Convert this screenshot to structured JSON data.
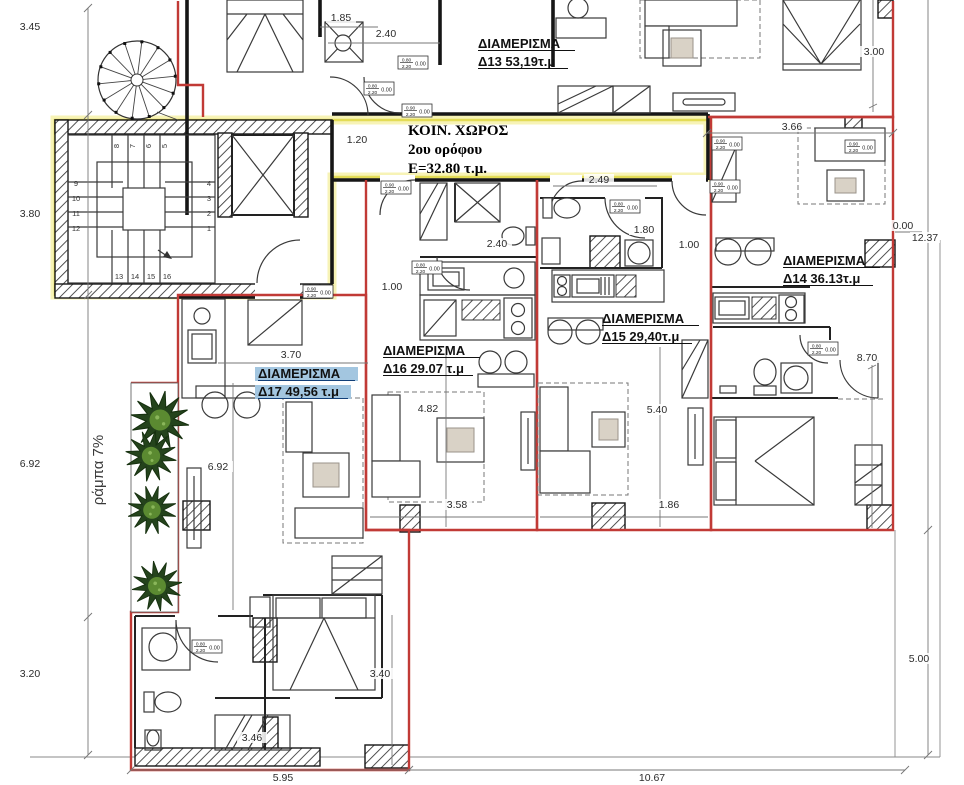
{
  "colors": {
    "apartment_boundary_red": "#c13a36",
    "common_boundary_yellow": "#e3dc55",
    "wall_black": "#161616",
    "highlight_fill": "#a3c6e0",
    "highlight_text": "#123f78",
    "tree_dark": "#24431c",
    "tree_light": "#5b8a31",
    "dimension_text": "#2b2b2b"
  },
  "common_area": {
    "line1": "ΚΟΙΝ. ΧΩΡΟΣ",
    "line2": "2ου ορόφου",
    "line3": "Ε=32.80 τ.μ."
  },
  "ramp_label": "ράμπα 7%",
  "apartments": [
    {
      "id": "d13",
      "title": "ΔΙΑΜΕΡΙΣΜΑ",
      "area": "Δ13 53,19τ.μ",
      "x": 478,
      "y": 48,
      "highlight": false
    },
    {
      "id": "d14",
      "title": "ΔΙΑΜΕΡΙΣΜΑ",
      "area": "Δ14 36.13τ.μ",
      "x": 783,
      "y": 265,
      "highlight": false
    },
    {
      "id": "d15",
      "title": "ΔΙΑΜΕΡΙΣΜΑ",
      "area": "Δ15 29,40τ.μ",
      "x": 602,
      "y": 323,
      "highlight": false
    },
    {
      "id": "d16",
      "title": "ΔΙΑΜΕΡΙΣΜΑ",
      "area": "Δ16 29.07 τ.μ",
      "x": 383,
      "y": 355,
      "highlight": false
    },
    {
      "id": "d17",
      "title": "ΔΙΑΜΕΡΙΣΜΑ",
      "area": "Δ17 49,56 τ.μ",
      "x": 258,
      "y": 378,
      "highlight": true
    }
  ],
  "dimensions": [
    {
      "t": "3.45",
      "x": 30,
      "y": 30
    },
    {
      "t": "3.80",
      "x": 30,
      "y": 217
    },
    {
      "t": "6.92",
      "x": 30,
      "y": 467
    },
    {
      "t": "3.20",
      "x": 30,
      "y": 677
    },
    {
      "t": "5.95",
      "x": 283,
      "y": 781
    },
    {
      "t": "10.67",
      "x": 652,
      "y": 781
    },
    {
      "t": "0.00",
      "x": 903,
      "y": 229
    },
    {
      "t": "12.37",
      "x": 925,
      "y": 241
    },
    {
      "t": "5.00",
      "x": 919,
      "y": 662
    },
    {
      "t": "3.00",
      "x": 874,
      "y": 55
    },
    {
      "t": "3.66",
      "x": 792,
      "y": 130
    },
    {
      "t": "8.70",
      "x": 867,
      "y": 361
    },
    {
      "t": "1.85",
      "x": 341,
      "y": 21
    },
    {
      "t": "2.40",
      "x": 386,
      "y": 37
    },
    {
      "t": "1.20",
      "x": 357,
      "y": 143
    },
    {
      "t": "2.40",
      "x": 497,
      "y": 247
    },
    {
      "t": "1.00",
      "x": 392,
      "y": 290
    },
    {
      "t": "2.49",
      "x": 599,
      "y": 183
    },
    {
      "t": "1.80",
      "x": 644,
      "y": 233
    },
    {
      "t": "1.00",
      "x": 689,
      "y": 248
    },
    {
      "t": "3.70",
      "x": 291,
      "y": 358
    },
    {
      "t": "6.92",
      "x": 218,
      "y": 470
    },
    {
      "t": "4.82",
      "x": 428,
      "y": 412
    },
    {
      "t": "3.58",
      "x": 457,
      "y": 508
    },
    {
      "t": "5.40",
      "x": 657,
      "y": 413
    },
    {
      "t": "1.86",
      "x": 669,
      "y": 508
    },
    {
      "t": "3.40",
      "x": 380,
      "y": 677
    },
    {
      "t": "3.46",
      "x": 252,
      "y": 741
    }
  ],
  "door_tags": [
    {
      "x": 364,
      "y": 82,
      "num": "0.80",
      "den": "2.20",
      "sill": "0.00"
    },
    {
      "x": 402,
      "y": 104,
      "num": "0.90",
      "den": "2.20",
      "sill": "0.00"
    },
    {
      "x": 398,
      "y": 56,
      "num": "0.80",
      "den": "2.20",
      "sill": "0.00"
    },
    {
      "x": 303,
      "y": 285,
      "num": "0.90",
      "den": "2.20",
      "sill": "0.00"
    },
    {
      "x": 381,
      "y": 181,
      "num": "0.90",
      "den": "2.20",
      "sill": "0.00"
    },
    {
      "x": 412,
      "y": 261,
      "num": "0.80",
      "den": "2.20",
      "sill": "0.00"
    },
    {
      "x": 610,
      "y": 200,
      "num": "0.80",
      "den": "2.20",
      "sill": "0.00"
    },
    {
      "x": 710,
      "y": 180,
      "num": "0.90",
      "den": "2.20",
      "sill": "0.00"
    },
    {
      "x": 712,
      "y": 137,
      "num": "0.90",
      "den": "2.20",
      "sill": "0.00"
    },
    {
      "x": 808,
      "y": 342,
      "num": "0.80",
      "den": "2.20",
      "sill": "0.00"
    },
    {
      "x": 192,
      "y": 640,
      "num": "0.80",
      "den": "2.20",
      "sill": "0.00"
    },
    {
      "x": 845,
      "y": 140,
      "num": "0.90",
      "den": "2.20",
      "sill": "0.00"
    }
  ],
  "stairs": {
    "left": [
      "9",
      "10",
      "11",
      "12"
    ],
    "right": [
      "4",
      "3",
      "2",
      "1"
    ],
    "top": [
      "8",
      "7",
      "6",
      "5"
    ],
    "bottom": [
      "13",
      "14",
      "15",
      "16"
    ]
  }
}
